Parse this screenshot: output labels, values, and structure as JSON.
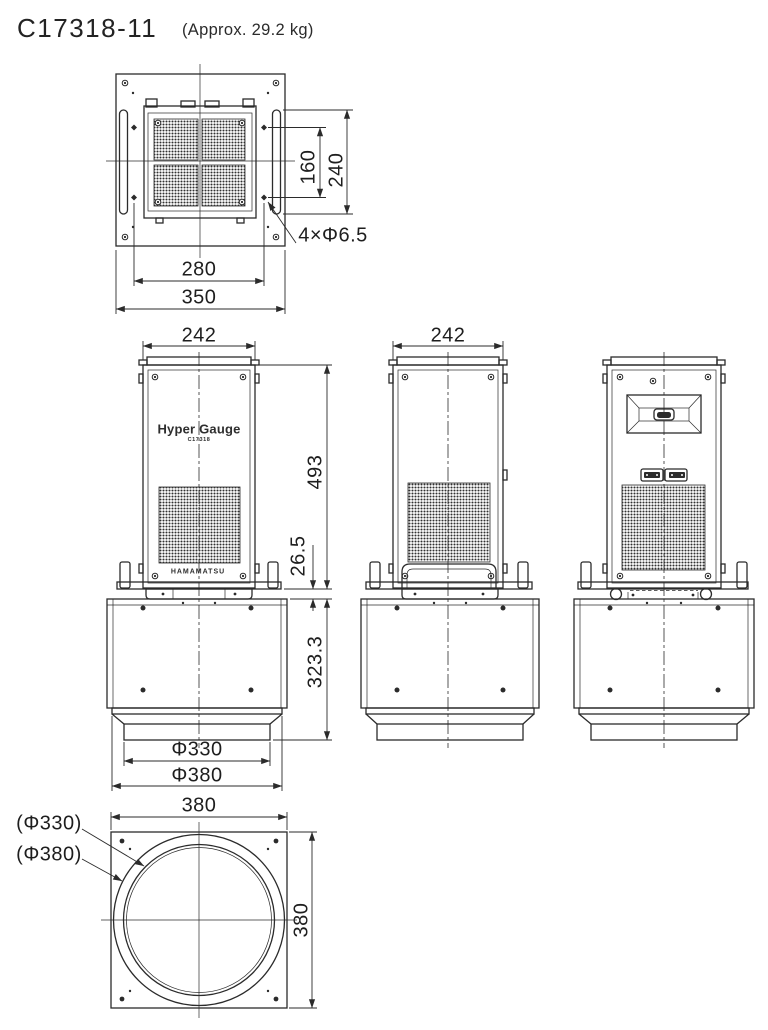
{
  "title": {
    "model": "C17318-11",
    "weight": "(Approx. 29.2 kg)"
  },
  "top_view": {
    "label": "Top view",
    "dim_hole_pitch_v": "160",
    "dim_slot_pitch_v": "240",
    "dim_hole_pitch_h": "280",
    "dim_plate_width": "350",
    "mounting_holes": "4×Φ6.5"
  },
  "front_view": {
    "label": "Front view",
    "dim_width": "242",
    "dim_body_height": "493",
    "dim_gap": "26.5",
    "dim_base_height": "323.3",
    "dim_neck_dia": "Φ330",
    "dim_base_dia": "Φ380",
    "logo_line1": "Hyper Gauge",
    "logo_line2": "C17318",
    "brand": "HAMAMATSU"
  },
  "side_view": {
    "label": "Side view",
    "dim_width": "242"
  },
  "rear_view": {
    "label": "Rear view"
  },
  "bottom_view": {
    "label": "Bottom view",
    "dim_width": "380",
    "dim_depth": "380",
    "ref_inner_dia": "(Φ330)",
    "ref_outer_dia": "(Φ380)"
  },
  "colors": {
    "line": "#2b2b2b",
    "text": "#1e1e1e",
    "background": "#ffffff"
  }
}
